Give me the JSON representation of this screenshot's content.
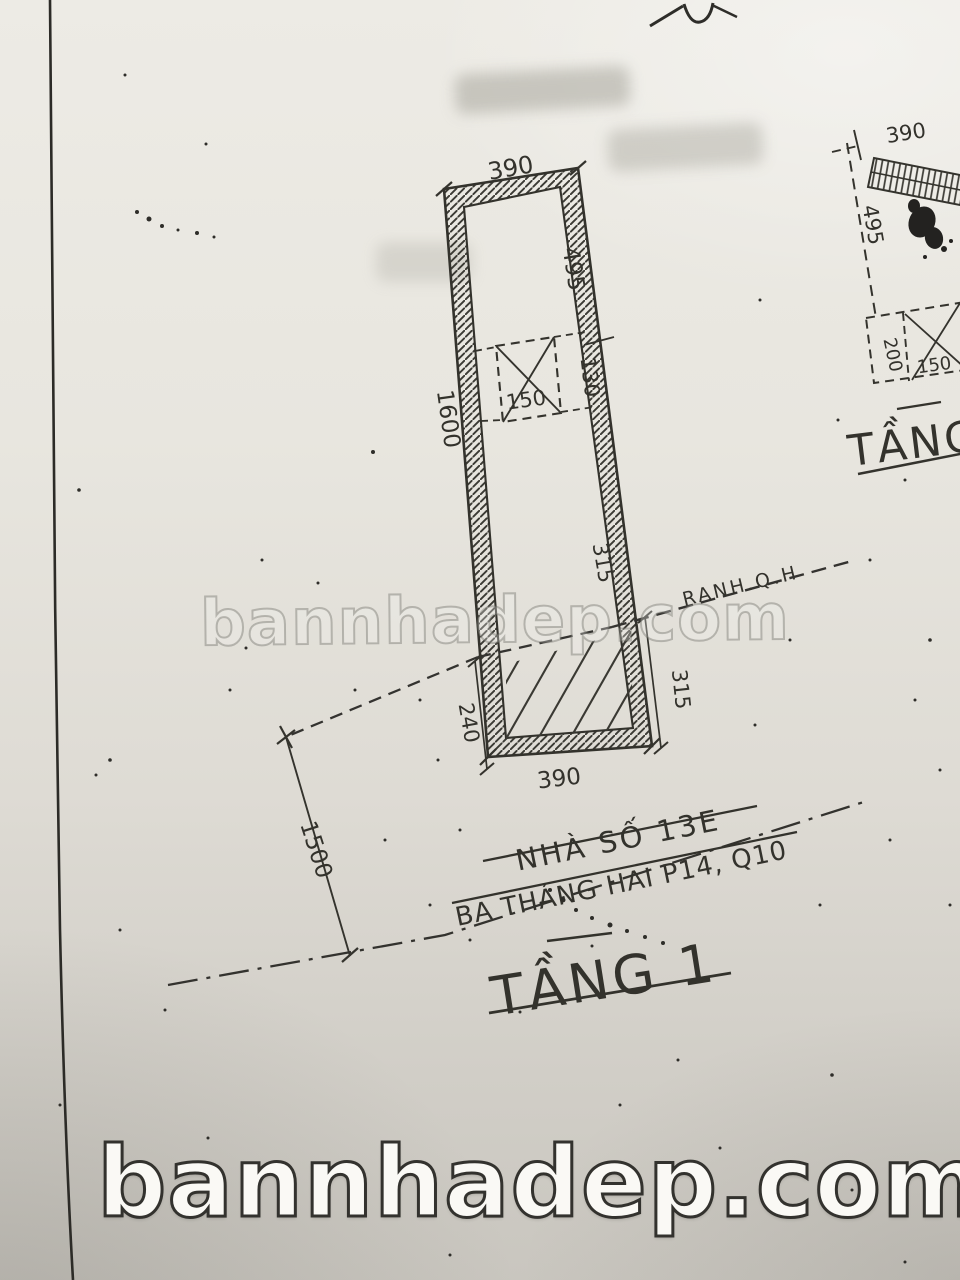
{
  "watermarks": {
    "center": "bannhadep.com",
    "bottom": "bannhadep.com"
  },
  "floor1": {
    "title": "TẦNG 1",
    "house_label": "NHÀ SỐ 13E",
    "street_label": "BA THÁNG HAI P14, Q10",
    "boundary_label": "RANH.Q.H",
    "dim_top": "390",
    "dim_right_upper": "495",
    "dim_left": "1600",
    "dim_void_width": "150",
    "dim_void_height": "130",
    "dim_right_inner": "315",
    "dim_right_lower": "315",
    "dim_left_lower": "240",
    "dim_bottom": "390",
    "dim_setback": "1500"
  },
  "floor2": {
    "title": "TẦNG",
    "dim_top": "390",
    "dim_left": "495",
    "dim_cell": "200",
    "dim_void": "150"
  }
}
